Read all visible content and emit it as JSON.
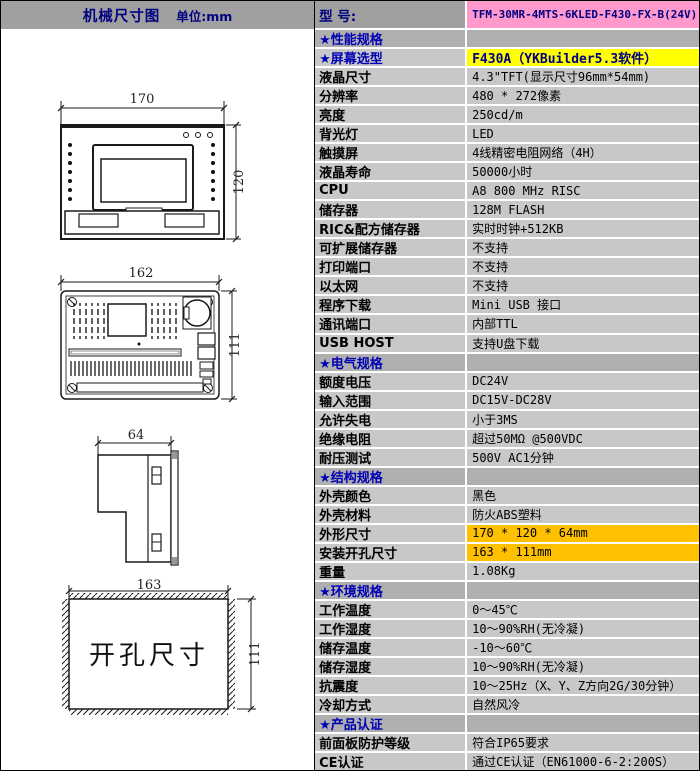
{
  "header": {
    "left_title": "机械尺寸图",
    "left_unit": "单位:mm",
    "model_label": "型  号:",
    "model_value": "TFM-30MR-4MTS-6KLED-F430-FX-B(24V)"
  },
  "drawings": {
    "front": {
      "width_dim": "170",
      "height_dim": "120"
    },
    "rear": {
      "width_dim": "162",
      "height_dim": "111"
    },
    "side": {
      "depth_dim": "64"
    },
    "cutout": {
      "width_dim": "163",
      "height_dim": "111",
      "label": "开孔尺寸"
    }
  },
  "colors": {
    "yellow": "#FFFF00",
    "orange": "#FFC000",
    "pink": "#FF99CC",
    "navy": "#000080",
    "section_blue": "#0000B4",
    "row_bg": "#C8C8C8",
    "section_bg": "#AFAFAF",
    "header_bg": "#A0A0A0"
  },
  "spec_rows": [
    {
      "kind": "section",
      "label": "★性能规格",
      "value": ""
    },
    {
      "kind": "normal",
      "label": "★屏幕选型",
      "value": "F430A（YKBuilder5.3软件）",
      "label_accent": true,
      "value_bg": "yellow",
      "value_bold": true
    },
    {
      "kind": "normal",
      "label": "液晶尺寸",
      "value": "4.3\"TFT(显示尺寸96mm*54mm)"
    },
    {
      "kind": "normal",
      "label": "分辨率",
      "value": "480 * 272像素"
    },
    {
      "kind": "normal",
      "label": "亮度",
      "value": "250cd/m"
    },
    {
      "kind": "normal",
      "label": "背光灯",
      "value": "LED"
    },
    {
      "kind": "normal",
      "label": "触摸屏",
      "value": "4线精密电阻网络（4H）"
    },
    {
      "kind": "normal",
      "label": "液晶寿命",
      "value": "50000小时"
    },
    {
      "kind": "normal",
      "label": "CPU",
      "value": "A8 800 MHz RISC"
    },
    {
      "kind": "normal",
      "label": "储存器",
      "value": "128M FLASH"
    },
    {
      "kind": "normal",
      "label": "RIC&配方储存器",
      "value": "实时时钟+512KB"
    },
    {
      "kind": "normal",
      "label": "可扩展储存器",
      "value": "不支持"
    },
    {
      "kind": "normal",
      "label": "打印端口",
      "value": "不支持"
    },
    {
      "kind": "normal",
      "label": "以太网",
      "value": "不支持"
    },
    {
      "kind": "normal",
      "label": "程序下载",
      "value": "Mini USB 接口"
    },
    {
      "kind": "normal",
      "label": "通讯端口",
      "value": "内部TTL"
    },
    {
      "kind": "normal",
      "label": "USB HOST",
      "value": "支持U盘下载"
    },
    {
      "kind": "section",
      "label": "★电气规格",
      "value": ""
    },
    {
      "kind": "normal",
      "label": "额度电压",
      "value": "DC24V"
    },
    {
      "kind": "normal",
      "label": "输入范围",
      "value": "DC15V-DC28V"
    },
    {
      "kind": "normal",
      "label": "允许失电",
      "value": "小于3MS"
    },
    {
      "kind": "normal",
      "label": "绝缘电阻",
      "value": "超过50MΩ @500VDC"
    },
    {
      "kind": "normal",
      "label": "耐压测试",
      "value": "500V AC1分钟"
    },
    {
      "kind": "section",
      "label": "★结构规格",
      "value": ""
    },
    {
      "kind": "normal",
      "label": "外壳颜色",
      "value": "黑色"
    },
    {
      "kind": "normal",
      "label": "外壳材料",
      "value": "防火ABS塑料"
    },
    {
      "kind": "normal",
      "label": "外形尺寸",
      "value": "170 * 120 * 64mm",
      "value_bg": "orange"
    },
    {
      "kind": "normal",
      "label": "安装开孔尺寸",
      "value": "163 * 111mm",
      "value_bg": "orange"
    },
    {
      "kind": "normal",
      "label": "重量",
      "value": "1.08Kg"
    },
    {
      "kind": "section",
      "label": "★环境规格",
      "value": ""
    },
    {
      "kind": "normal",
      "label": "工作温度",
      "value": "0～45℃"
    },
    {
      "kind": "normal",
      "label": "工作湿度",
      "value": "10～90%RH(无冷凝)"
    },
    {
      "kind": "normal",
      "label": "储存温度",
      "value": "-10～60℃"
    },
    {
      "kind": "normal",
      "label": "储存湿度",
      "value": "10～90%RH(无冷凝)"
    },
    {
      "kind": "normal",
      "label": "抗震度",
      "value": "10～25Hz（X、Y、Z方向2G/30分钟）"
    },
    {
      "kind": "normal",
      "label": "冷却方式",
      "value": "自然风冷"
    },
    {
      "kind": "section",
      "label": "★产品认证",
      "value": ""
    },
    {
      "kind": "normal",
      "label": "前面板防护等级",
      "value": "符合IP65要求"
    },
    {
      "kind": "normal",
      "label": "CE认证",
      "value": "通过CE认证（EN61000-6-2:200S）"
    }
  ]
}
